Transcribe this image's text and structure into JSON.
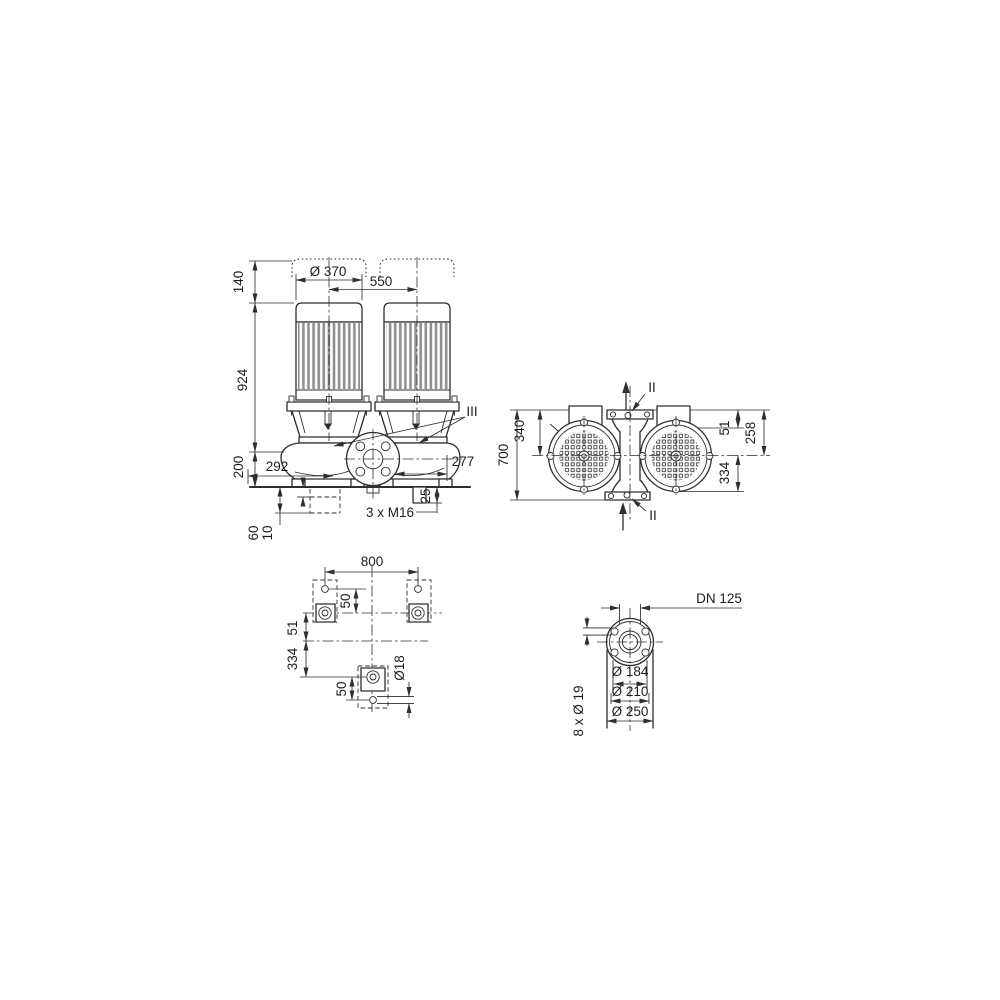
{
  "drawing": {
    "background": "#ffffff",
    "line_color": "#2e2e2e",
    "fin_color": "#8f8f8f",
    "front_view": {
      "clearance": "140",
      "motor_diameter": "Ø 370",
      "motor_spacing": "550",
      "height_total": "924",
      "height_base": "200",
      "offset_left": "292",
      "offset_right": "277",
      "stud_projection": "25",
      "studs_label": "3 x M16",
      "foundation_depth": "60",
      "grout_thickness": "10",
      "section_marker": "III"
    },
    "top_view": {
      "depth_total": "700",
      "port_to_center": "340",
      "box_offset": "51",
      "center_to_face": "258",
      "center_to_edge": "334",
      "section_top": "II",
      "section_bottom": "II"
    },
    "foundation_view": {
      "bolt_spacing": "800",
      "hole_offset_top": "50",
      "center_offset": "51",
      "row_spacing": "334",
      "hole_offset_bottom": "50",
      "hole_diameter": "Ø18"
    },
    "flange_view": {
      "nominal_diameter": "DN 125",
      "pilot_diameter": "Ø 184",
      "bolt_circle_diameter": "Ø 210",
      "outer_diameter": "Ø 250",
      "bolt_holes": "8 x Ø 19"
    }
  }
}
